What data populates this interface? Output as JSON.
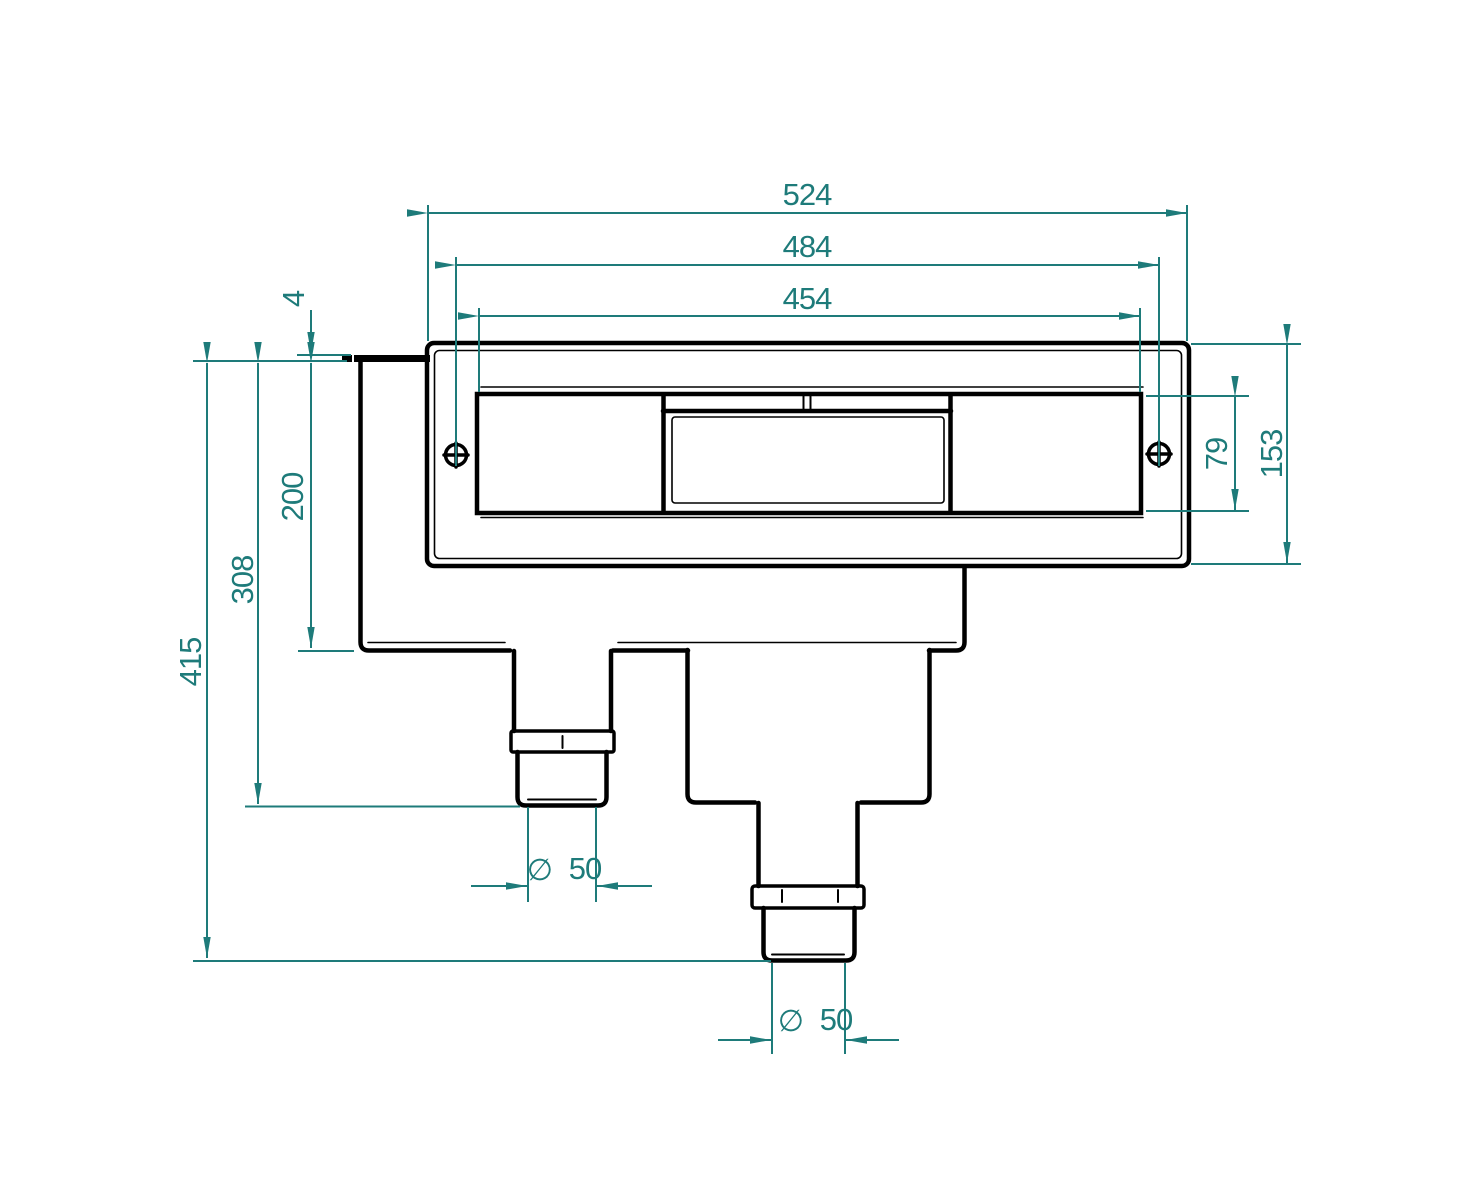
{
  "drawing": {
    "type": "technical-drawing",
    "subject": "pool-skimmer-front-elevation",
    "units_note": "",
    "colors": {
      "dimension": "#1e7b7a",
      "outline": "#000000",
      "background": "#ffffff"
    },
    "dimensions": {
      "width_outer": {
        "value": "524"
      },
      "width_screws": {
        "value": "484"
      },
      "width_opening": {
        "value": "454"
      },
      "lip_thickness": {
        "value": "4"
      },
      "depth_body": {
        "value": "200"
      },
      "depth_pipe_left": {
        "value": "308"
      },
      "depth_total": {
        "value": "415"
      },
      "opening_height": {
        "value": "79"
      },
      "faceplate_height": {
        "value": "153"
      },
      "pipe_left_diameter": {
        "symbol": "∅",
        "value": "50"
      },
      "pipe_bottom_diameter": {
        "symbol": "∅",
        "value": "50"
      }
    }
  }
}
